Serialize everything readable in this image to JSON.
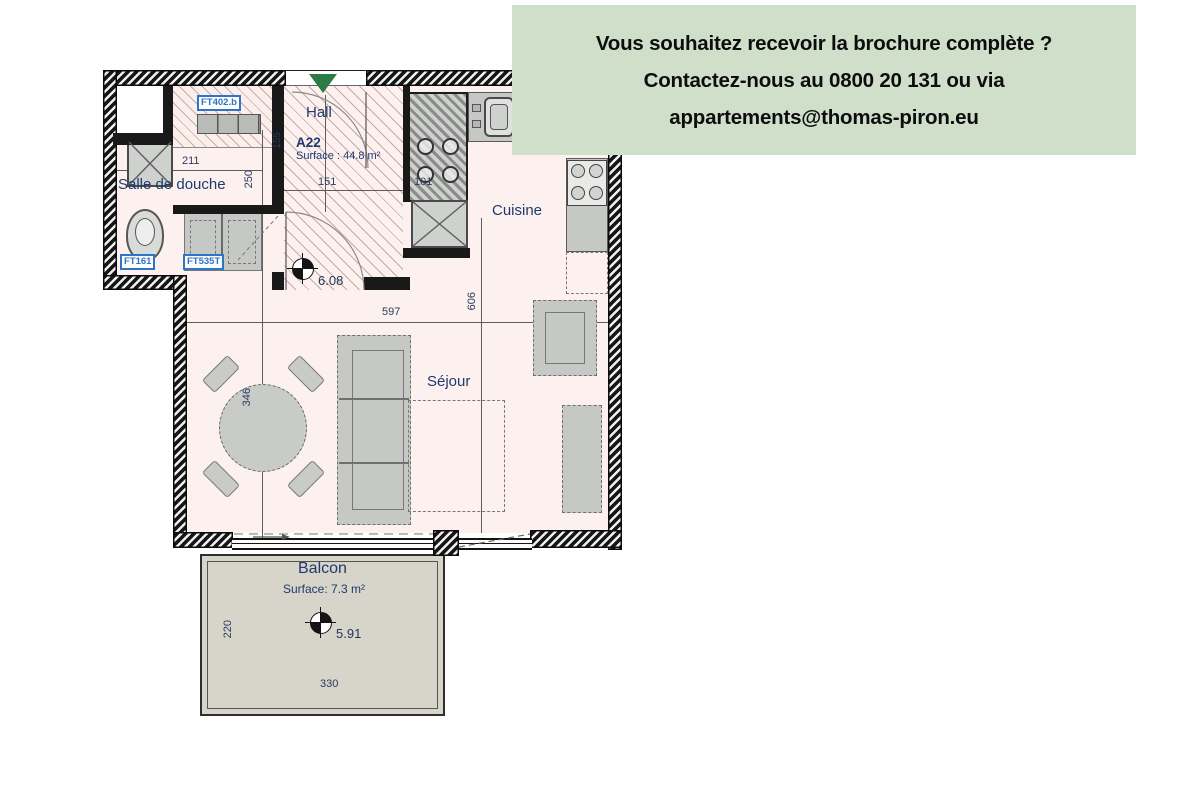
{
  "banner": {
    "line1": "Vous souhaitez recevoir la brochure complète ?",
    "line2": "Contactez-nous au 0800 20 131 ou via",
    "line3": "appartements@thomas-piron.eu"
  },
  "plan": {
    "unit": {
      "code": "A22",
      "surface": "Surface : 44.8 m²"
    },
    "rooms": {
      "bathroom": "Salle de douche",
      "hall": "Hall",
      "kitchen": "Cuisine",
      "living": "Séjour",
      "balcony": "Balcon",
      "balcony_surface": "Surface: 7.3 m²"
    },
    "levels": {
      "main": "6.08",
      "balcony": "5.91"
    },
    "dims": {
      "d211": "211",
      "d250": "250",
      "d155": "155",
      "d151": "151",
      "d101": "101",
      "d597": "597",
      "d606": "606",
      "d346": "346",
      "d220": "220",
      "d330": "330"
    },
    "tags": {
      "t1": "FT402.b",
      "t2": "FT161",
      "t3": "FT535T"
    },
    "colors": {
      "banner_bg": "#cfdfca",
      "entry_green": "#2c7a45",
      "tag_blue": "#2e75c8",
      "label_navy": "#1e3a6e",
      "floor_pink": "#fcf1ee",
      "balcony_gray": "#d7d4ca"
    }
  }
}
